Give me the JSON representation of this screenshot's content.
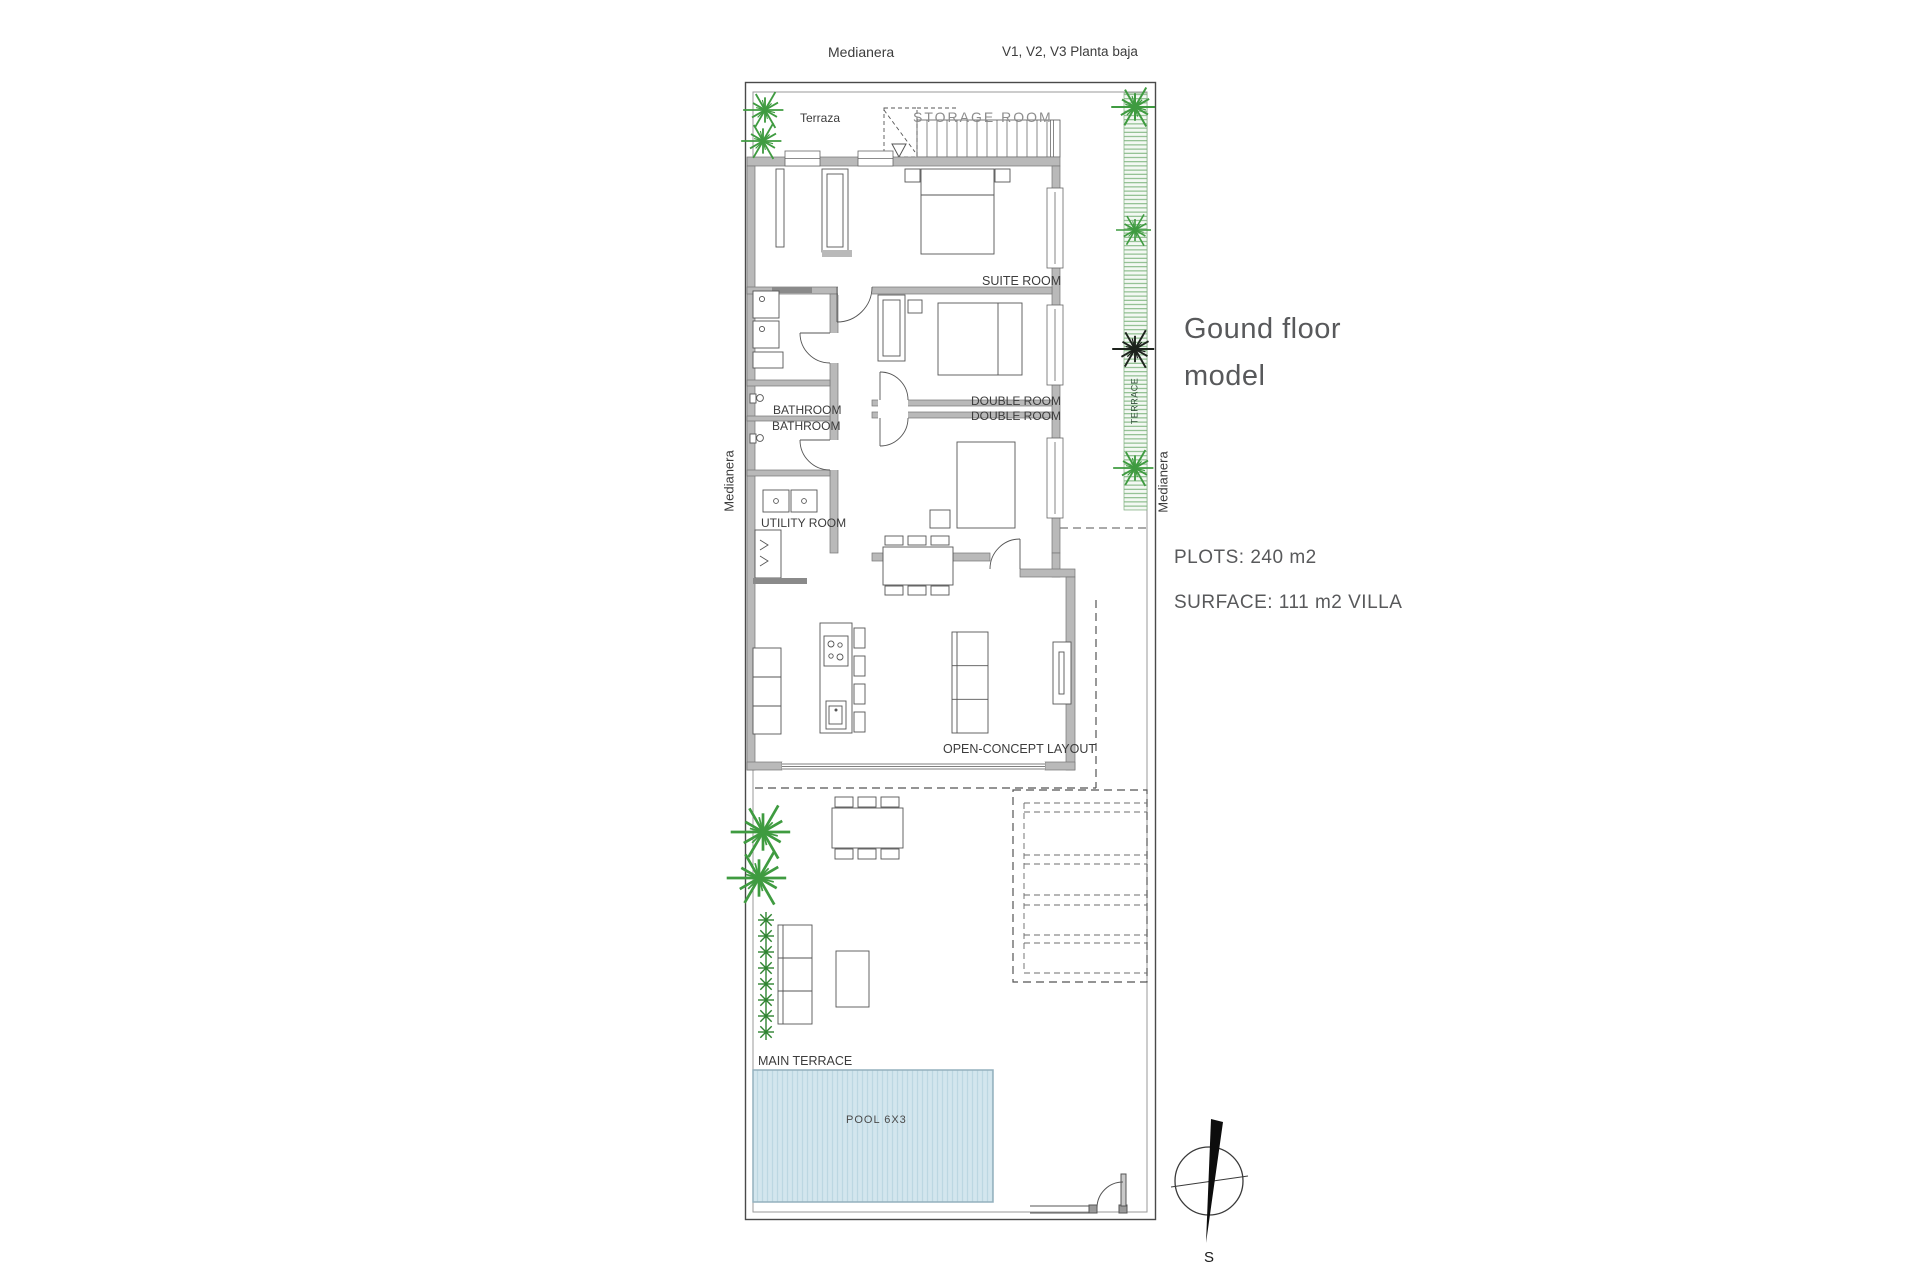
{
  "annotations": {
    "medianera_top": "Medianera",
    "planta_note": "V1, V2, V3 Planta baja",
    "medianera_left": "Medianera",
    "medianera_right": "Medianera",
    "terrace_strip": "TERRACE"
  },
  "rooms": {
    "terraza": "Terraza",
    "storage": "STORAGE ROOM",
    "suite": "SUITE ROOM",
    "bathroom_1": "BATHROOM",
    "bathroom_2": "BATHROOM",
    "double_1": "DOUBLE ROOM",
    "double_2": "DOUBLE ROOM",
    "utility": "UTILITY ROOM",
    "open_concept": "OPEN-CONCEPT LAYOUT",
    "main_terrace": "MAIN TERRACE",
    "pool": "POOL 6X3"
  },
  "info_panel": {
    "title": "Gound floor model",
    "plots": "PLOTS: 240 m2",
    "surface": "SURFACE: 111 m2 VILLA"
  },
  "compass": {
    "south_label": "S"
  },
  "colors": {
    "wall_fill": "#b9b9b9",
    "wall_stroke": "#767676",
    "line": "#4a4a4a",
    "label_text": "#3c3c3c",
    "muted_label": "#8d8d8d",
    "heading_text": "#58595b",
    "plant_green": "#3f9b40",
    "plant_dark": "#1d231d",
    "pool_fill": "#d3e6ee",
    "pool_stripe": "#bcd7e2",
    "pool_border": "#94b0bd",
    "terrace_hatch": "#79b279"
  }
}
